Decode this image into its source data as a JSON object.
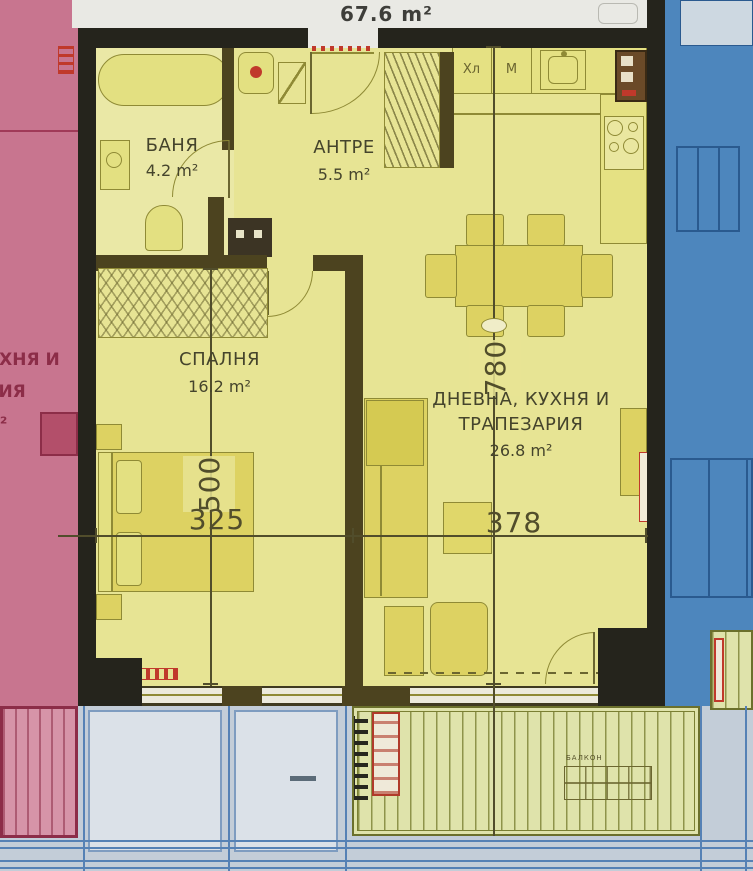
{
  "header": {
    "total_area": "67.6 m²"
  },
  "rooms": {
    "bathroom": {
      "name": "БАНЯ",
      "area": "4.2 m²"
    },
    "hall": {
      "name": "АНТРЕ",
      "area": "5.5 m²"
    },
    "bedroom": {
      "name": "СПАЛНЯ",
      "area": "16.2 m²"
    },
    "living": {
      "name_line1": "ДНЕВНА, КУХНЯ И",
      "name_line2": "ТРАПЕЗАРИЯ",
      "area": "26.8 m²"
    }
  },
  "kitchen": {
    "fridge_label": "Хл",
    "washer_label": "М"
  },
  "dimensions": {
    "living_depth_cm": "780",
    "bedroom_depth_cm": "500",
    "bedroom_width_cm": "325",
    "living_width_cm": "378"
  },
  "neighbor_left": {
    "label_line1": "УХНЯ И",
    "label_line2": "РИЯ",
    "label_line3": "м²"
  },
  "balcony": {
    "label": "БАЛКОН"
  },
  "colors": {
    "apartment_fill": "#e7e494",
    "apartment_light": "#eae8a6",
    "furniture_fill": "#ddd262",
    "furniture_dark": "#d5ca52",
    "line_olive": "#8f8a35",
    "wall_black": "#25241c",
    "wall_brown": "#4c431f",
    "neighbor_pink": "#c8758f",
    "pink_dark": "#8c2d48",
    "neighbor_blue": "#4d86bd",
    "blue_line": "#2a5a8f",
    "balcony_green": "#dfe3ab",
    "balcony_line": "#7a7f33",
    "accent_red": "#c0392b",
    "bottom_blue": "#c3cdd8",
    "panel_light": "#dbe1e8",
    "grid_blue": "#5581b5",
    "top_band": "#e9e9e4",
    "dim_color": "#514d2b",
    "label_color": "#45442c"
  }
}
